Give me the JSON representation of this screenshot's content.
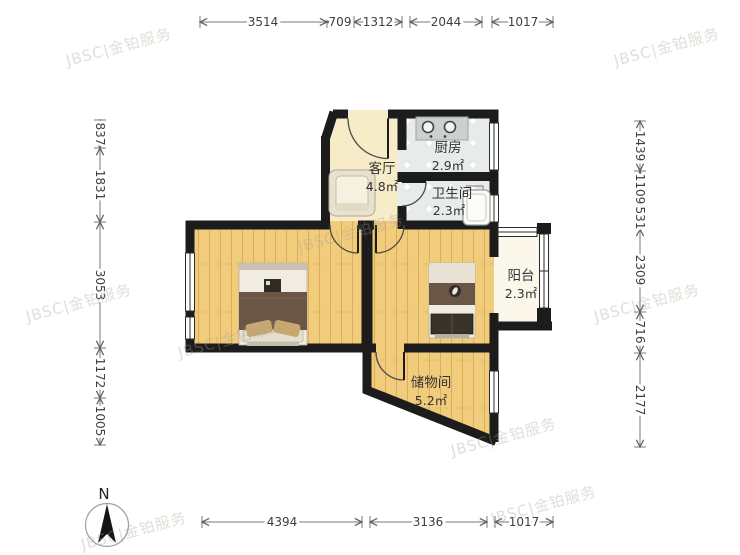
{
  "title": "户型图",
  "watermark": {
    "text": "JBSC|金铂服务"
  },
  "compass": {
    "north_label": "N"
  },
  "rooms": {
    "living": {
      "name": "客厅",
      "area": "4.8㎡"
    },
    "kitchen": {
      "name": "厨房",
      "area": "2.9㎡"
    },
    "bathroom": {
      "name": "卫生间",
      "area": "2.3㎡"
    },
    "balcony": {
      "name": "阳台",
      "area": "2.3㎡"
    },
    "storage": {
      "name": "储物间",
      "area": "5.2㎡"
    }
  },
  "dimensions": {
    "top": [
      "3514",
      "709",
      "1312",
      "2044",
      "1017"
    ],
    "left": [
      "837",
      "1831",
      "3053",
      "1172",
      "1005"
    ],
    "right": [
      "1439",
      "1109",
      "531",
      "2309",
      "716",
      "2177"
    ],
    "bottom": [
      "4394",
      "3136",
      "1017"
    ]
  },
  "colors": {
    "wall": "#1c1c1c",
    "wood_floor": "#f1cc7d",
    "cream_floor": "#f6ecc7",
    "tile_floor": "#e8ebeb",
    "balcony_floor": "#fbf7ea",
    "watermark": "#a89f8f",
    "dim_line": "#75797e",
    "dim_text": "#3c4043",
    "label_text": "#333333",
    "bed_blanket": "#695646",
    "cushion": "#c8a870"
  }
}
